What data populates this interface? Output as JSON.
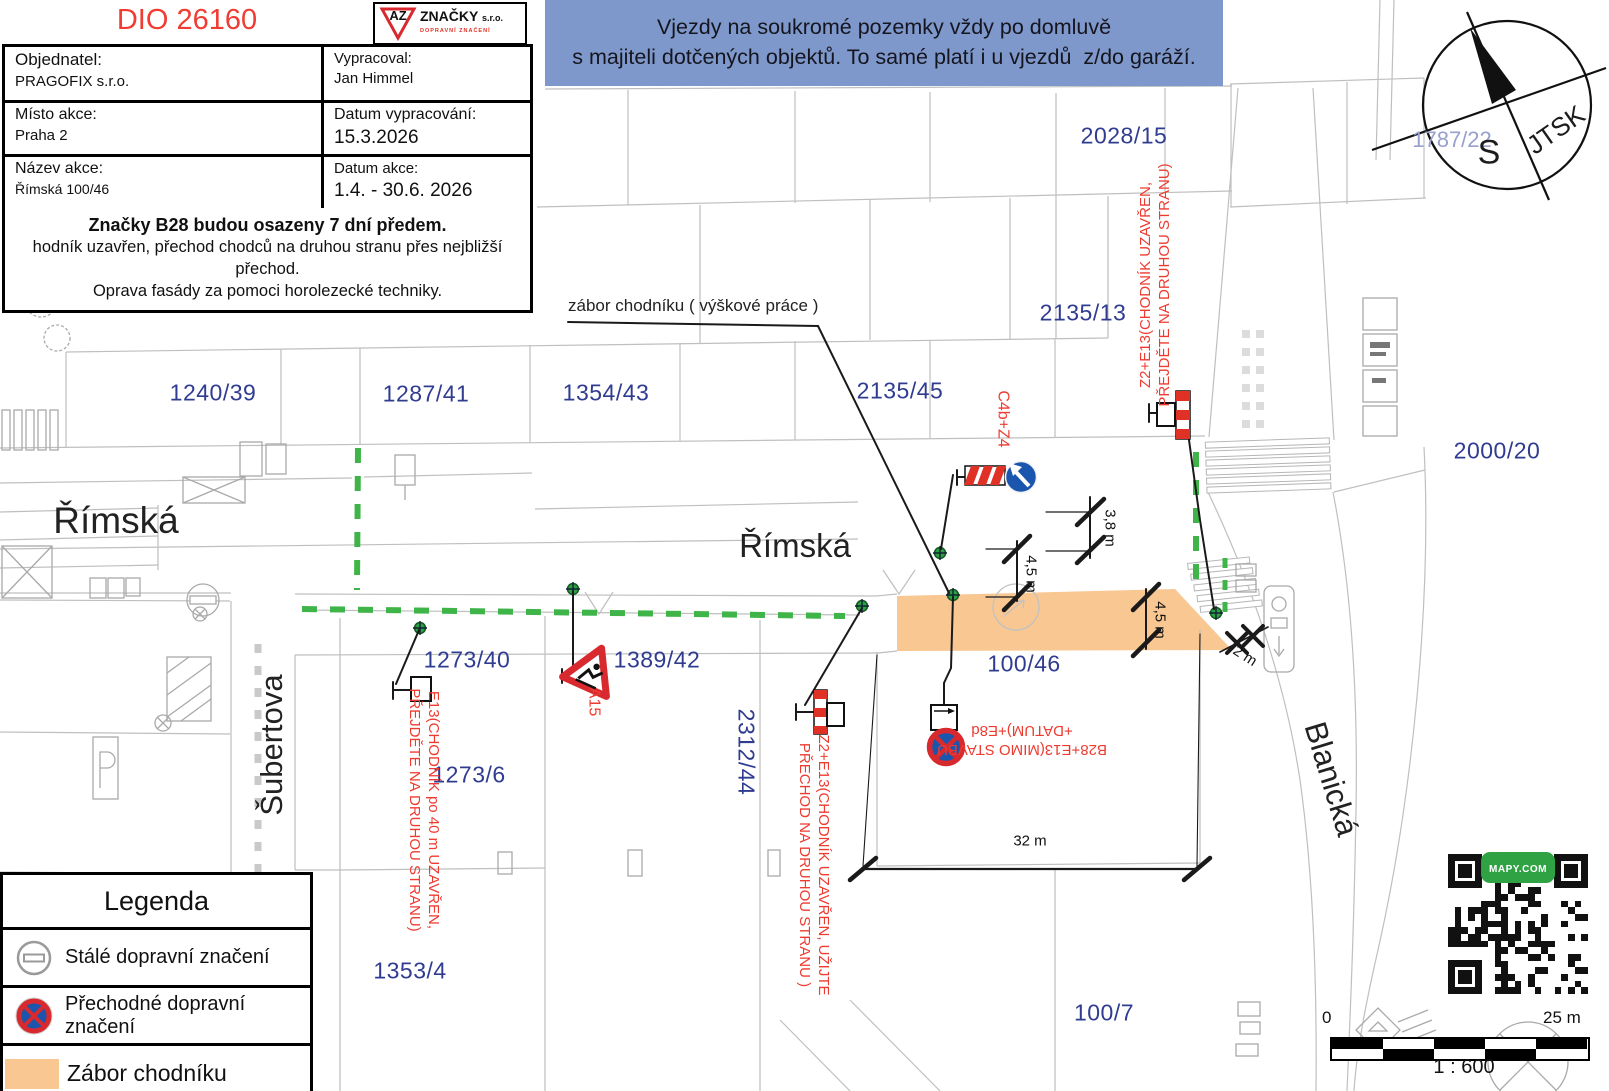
{
  "title_block": {
    "dio_number": "DIO 26160",
    "logo": {
      "az": "AZ",
      "company": "ZNAČKY",
      "suffix": "s.r.o.",
      "tagline": "DOPRAVNÍ ZNAČENÍ"
    },
    "rows": [
      {
        "label": "Objednatel:",
        "value": "PRAGOFIX s.r.o.",
        "label2": "Vypracoval:",
        "value2": "Jan Himmel"
      },
      {
        "label": "Místo akce:",
        "value": "Praha 2",
        "label2": "Datum vypracování:",
        "value2": "15.3.2026"
      },
      {
        "label": "Název akce:",
        "value": "Římská 100/46",
        "label2": "Datum akce:",
        "value2": "1.4. - 30.6. 2026"
      }
    ],
    "note_bold": "Značky B28 budou osazeny 7 dní předem.",
    "note_line2": "hodník uzavřen, přechod chodců na druhou stranu přes nejbližší přechod.",
    "note_line3": "Oprava fasády za pomoci horolezecké techniky."
  },
  "banner": {
    "line1": "Vjezdy na soukromé pozemky vždy po domluvě",
    "line2": "s majiteli dotčených objektů. To samé platí i u vjezdů  z/do garáží."
  },
  "compass": {
    "jtsk": "JTSK",
    "south": "S"
  },
  "streets": [
    {
      "text": "Římská"
    },
    {
      "text": "Římská"
    },
    {
      "text": "Šubertova"
    },
    {
      "text": "Blanická"
    }
  ],
  "parcels": [
    {
      "text": "1240/39"
    },
    {
      "text": "1287/41"
    },
    {
      "text": "1354/43"
    },
    {
      "text": "2135/45"
    },
    {
      "text": "2028/15"
    },
    {
      "text": "2135/13"
    },
    {
      "text": "2000/20"
    },
    {
      "text": "1787/22"
    },
    {
      "text": "1273/40"
    },
    {
      "text": "1389/42"
    },
    {
      "text": "1273/6"
    },
    {
      "text": "2312/44"
    },
    {
      "text": "100/46"
    },
    {
      "text": "1353/4"
    },
    {
      "text": "100/7"
    }
  ],
  "annotations": [
    {
      "lines": [
        "Z2+E13(CHODNÍK UZAVŘEN,",
        "PŘEJDĚTE NA DRUHOU STRANU)"
      ]
    },
    {
      "lines": [
        "C4b+Z4"
      ]
    },
    {
      "lines": [
        "E13(CHODNÍK po 40 m UZAVŘEN,",
        "PŘEJDĚTE NA DRUHOU STRANU)"
      ]
    },
    {
      "lines": [
        "A15"
      ]
    },
    {
      "lines": [
        "Z2+E13(CHODNÍK UZAVŘEN, UŽIJTE",
        "PŘECHOD NA DRUHOU STRANU )"
      ]
    },
    {
      "lines": [
        "B28+E13(MIMO STAVBU",
        "+DATUM)+E8d"
      ]
    }
  ],
  "callout": {
    "text": "zábor chodníku ( výškové práce )"
  },
  "dimensions": [
    {
      "text": "3,8 m"
    },
    {
      "text": "4,5 m"
    },
    {
      "text": "4,5 m"
    },
    {
      "text": "2 m"
    },
    {
      "text": "32 m"
    }
  ],
  "legend": {
    "title": "Legenda",
    "items": [
      {
        "label": "Stálé dopravní značení"
      },
      {
        "label": "Přechodné dopravní značení"
      },
      {
        "label": "Zábor chodníku"
      }
    ]
  },
  "scale_bar": {
    "start": "0",
    "end": "25 m",
    "ratio": "1 : 600"
  },
  "qr": {
    "badge": "MAPY.COM"
  },
  "colors": {
    "accent_red": "#ee3b30",
    "parcel_blue": "#2f3c90",
    "banner_blue": "#7e98cb",
    "occupation_orange": "#f9c791",
    "work_green": "#3eb449"
  }
}
